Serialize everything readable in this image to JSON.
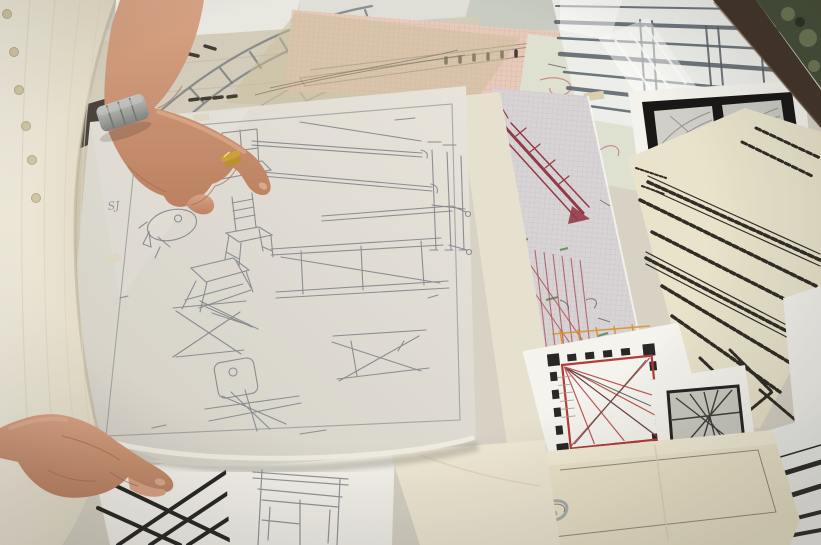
{
  "scene": {
    "description": "Photograph taken from above-left: an older person wearing a cream knitted button cardigan over a white top leafs through a pile of architectural and furniture design drawings spread on a table. Their right hand, with a gold ring and steel bracelet watch, points at a large tracing-paper sheet covered with pencil sketches of chairs and stools; their left hand lifts the sheet's lower corner. Beneath and around it lie graph-paper sheets with red, orange and teal technical drawings, a black-ink hatched isometric drawing, a castle floor plan with red sight lines, photo negatives on a black card, striped elevation drawings, a cream folder with a large wire clip, and crumpled plastic wrap; a dark table edge and green foliage show in the top right corner.",
    "handwriting": "SJ"
  },
  "objects": [
    "cream-knit-cardigan",
    "white-sleeve",
    "right-pointing-hand",
    "gold-ring",
    "steel-watch",
    "left-lifting-hand",
    "tracing-paper-furniture-sketch",
    "curved-track-drawing",
    "pink-graph-paper",
    "tan-tracing-overlay",
    "red-scribble-sheet",
    "graph-sheet-colored-drawing",
    "ink-isometric-sheet",
    "photo-negatives-card",
    "striped-elevation-sheets",
    "plastic-wrap",
    "table-edge",
    "foliage",
    "castle-floor-plan",
    "dark-framed-sketch",
    "cream-folder",
    "wire-clip",
    "black-grid-sheet",
    "chair-sketch-sheet"
  ],
  "colors": {
    "wall": "#c8ccc3",
    "table_paper": "#d6d2c6",
    "stack_band": "#d2ccbb",
    "white_band": "#e9e9e3",
    "track_gray": "#70777d",
    "dark_mark": "#3a362e",
    "pink_paper": "#e6cbbc",
    "pink_line": "#d89a8e",
    "tan_overlay": "#c9bb9b",
    "profile": "#6b6558",
    "pale_sheet": "#dfe2d2",
    "red_scribble": "#c46a70",
    "graph_paper": "#d7d3d6",
    "graph_line": "#bcb6c0",
    "crimson": "#8e3342",
    "red_line": "#a84a52",
    "orange": "#d88f2e",
    "green_mark": "#4d8050",
    "teal": "#3f5c68",
    "squiggle": "#4a4f57",
    "cream_strip": "#e6e1d0",
    "stripes_sheet": "#eef0ee",
    "stripe_gray": "#4e5a64",
    "plastic": "#ffffff",
    "chip": "#d9cfae",
    "photo_under": "#f4f4f0",
    "photo_black": "#0e0e0e",
    "photo_l": "#cfd0cb",
    "photo_r": "#c7c9c4",
    "photo_scribble": "#8e918c",
    "wood": "#3a2d24",
    "wood_edge": "#6b5a44",
    "foliage": "#3c4733",
    "leaf_light": "#8fa06f",
    "leaf_dark": "#222a1c",
    "ink": "#26241f",
    "cream_ink_sheet": "#e9e4cd",
    "white_gap": "#f2f2ee",
    "plan_sheet": "#f6f5f1",
    "plan_black": "#1f1f1f",
    "plan_red": "#b03434",
    "plan_gray": "#3a3a38",
    "stair": "#9a9a94",
    "sketch_frame": "#1d1d1b",
    "sketch_bg": "#c9c9c2",
    "folder": "#ece5cc",
    "folder_flap": "#f4efdb",
    "folder_line": "#6b6154",
    "crease": "#d9d2ba",
    "clip": "#a7adaf",
    "clip_dark": "#5c6163",
    "stripe_black": "#222222",
    "white_sheet": "#f4f3ee",
    "grid_black": "#1f1f1f",
    "pencil": "#7d818a",
    "chair_pencil": "#84878f",
    "pencil_border": "#8d9097",
    "edge_curl": "#f2efe7",
    "sheet_shadow": "#8a857a",
    "tape": "#ddd5c4",
    "tracing_light": "#e8e5de",
    "tracing_dark": "#d2cfc7",
    "cardigan_light": "#f0ecdf",
    "cardigan_dark": "#ded7c2",
    "cardigan_shadow": "#b7ad93",
    "knit_line": "#d9d3c0",
    "button": "#cfc4a6",
    "button_edge": "#b5a887",
    "sleeve_white": "#f7f6f1",
    "skin_light": "#d7a083",
    "skin_dark": "#b97e5e",
    "skin_line": "#9c6749",
    "skin_highlight": "#e6b896",
    "nail": "#dcab8d",
    "fingertip": "#d9a184",
    "watch_light": "#c2c5c2",
    "watch_dark": "#7b7e7b",
    "watch_line": "#6d706d",
    "gold": "#c9a12e",
    "gold_dark": "#b8901f",
    "gold_shine": "#f3dc82",
    "shadow_wedge": "#34302a",
    "dark_patch": "#5d564e"
  }
}
